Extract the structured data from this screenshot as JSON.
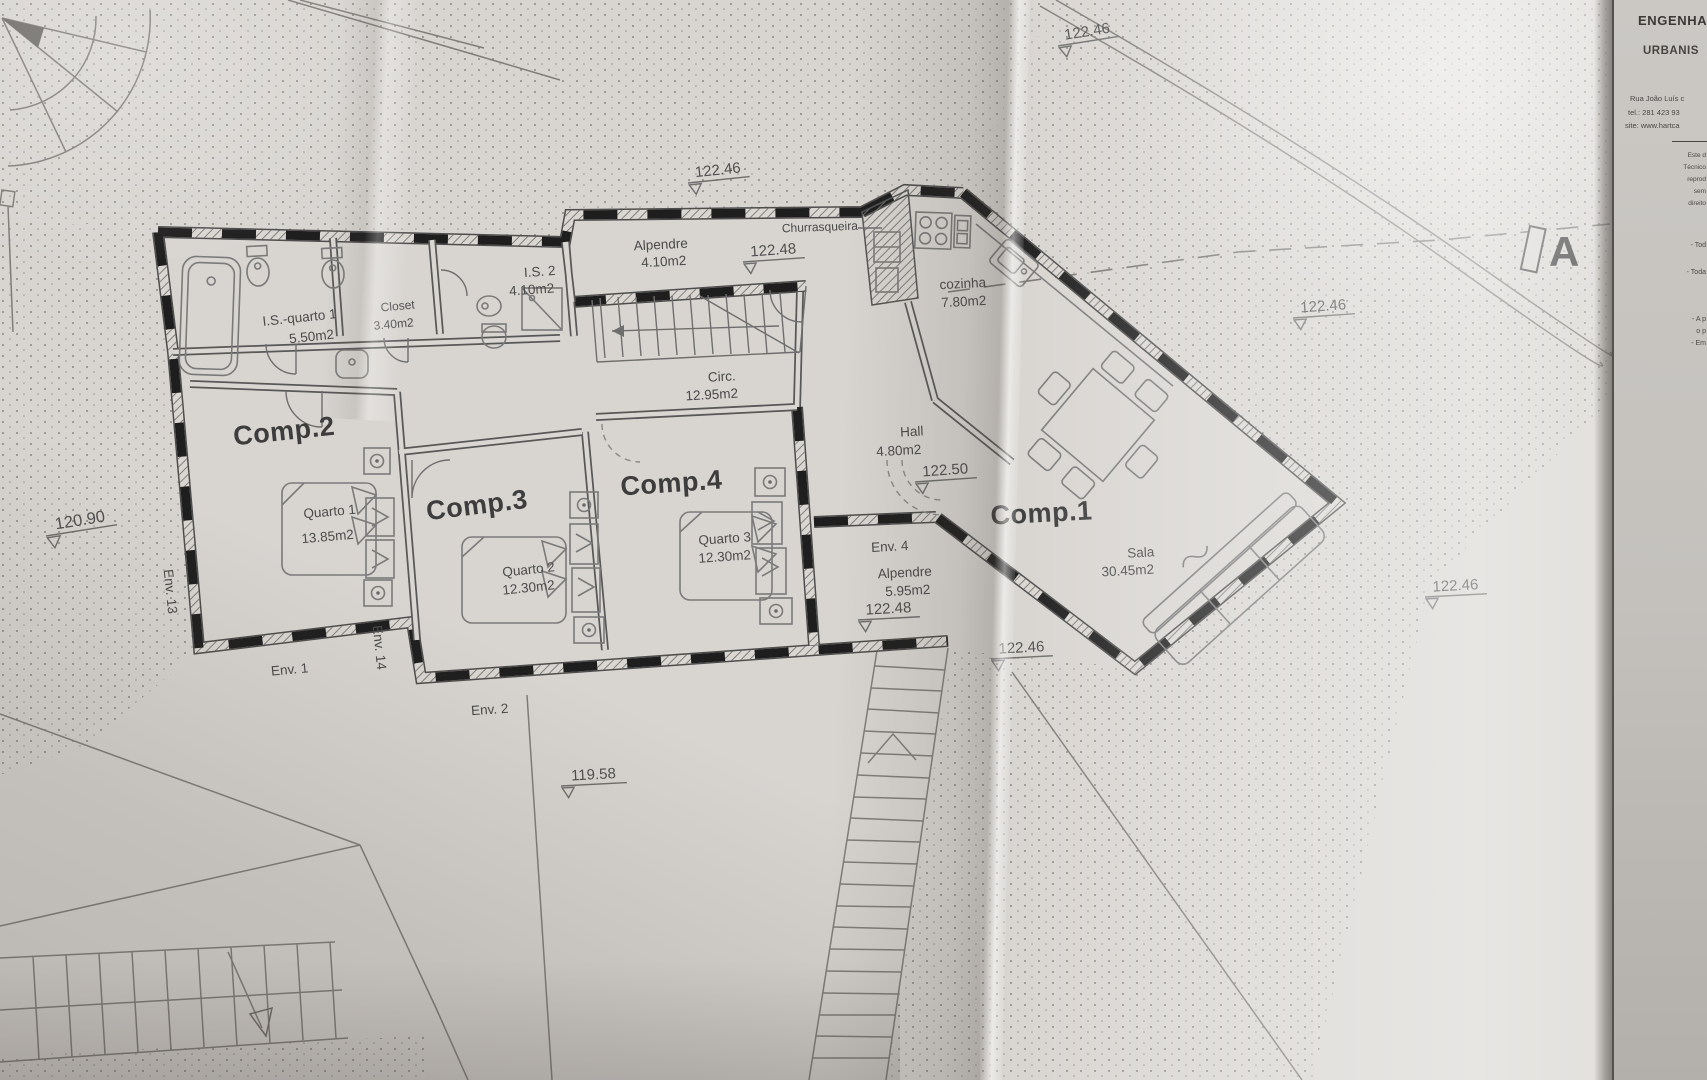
{
  "drawing": {
    "section_marker": "A",
    "rooms": {
      "is_quarto1": {
        "name": "I.S.-quarto 1",
        "area": "5.50m2"
      },
      "closet": {
        "name": "Closet",
        "area": "3.40m2"
      },
      "is2": {
        "name": "I.S. 2",
        "area": "4.10m2"
      },
      "alpendre_top": {
        "name": "Alpendre",
        "area": "4.10m2"
      },
      "churrasqueira": {
        "name": "Churrasqueira"
      },
      "cozinha": {
        "name": "cozinha",
        "area": "7.80m2"
      },
      "circ": {
        "name": "Circ.",
        "area": "12.95m2"
      },
      "hall": {
        "name": "Hall",
        "area": "4.80m2"
      },
      "comp1": {
        "name": "Comp.1"
      },
      "comp2": {
        "name": "Comp.2"
      },
      "comp3": {
        "name": "Comp.3"
      },
      "comp4": {
        "name": "Comp.4"
      },
      "quarto1": {
        "name": "Quarto 1",
        "area": "13.85m2"
      },
      "quarto2": {
        "name": "Quarto 2",
        "area": "12.30m2"
      },
      "quarto3": {
        "name": "Quarto 3",
        "area": "12.30m2"
      },
      "sala": {
        "name": "Sala",
        "area": "30.45m2"
      },
      "env4_alpendre": {
        "name": "Alpendre",
        "area": "5.95m2"
      }
    },
    "env_labels": {
      "env1": "Env. 1",
      "env2": "Env. 2",
      "env4": "Env. 4",
      "env13": "Env. 13",
      "env14": "Env. 14"
    },
    "levels": {
      "l0": "122.46",
      "l1": "122.46",
      "l2": "122.48",
      "l3": "122.46",
      "l4": "122.50",
      "l5": "122.48",
      "l6": "122.46",
      "l7": "122.46",
      "l8": "120.90",
      "l9": "119.58"
    }
  },
  "title_block": {
    "line1": "ENGENHA",
    "line2": "URBANIS",
    "address": "Rua João Luís c",
    "phone": "tel.: 281 423 93",
    "website": "site: www.hartca",
    "notes": [
      "Este d",
      "Técnico",
      "reprod",
      "sem",
      "direito"
    ],
    "items": [
      "- Tod",
      "- Toda",
      "- A p",
      "o p",
      "- Em"
    ]
  }
}
